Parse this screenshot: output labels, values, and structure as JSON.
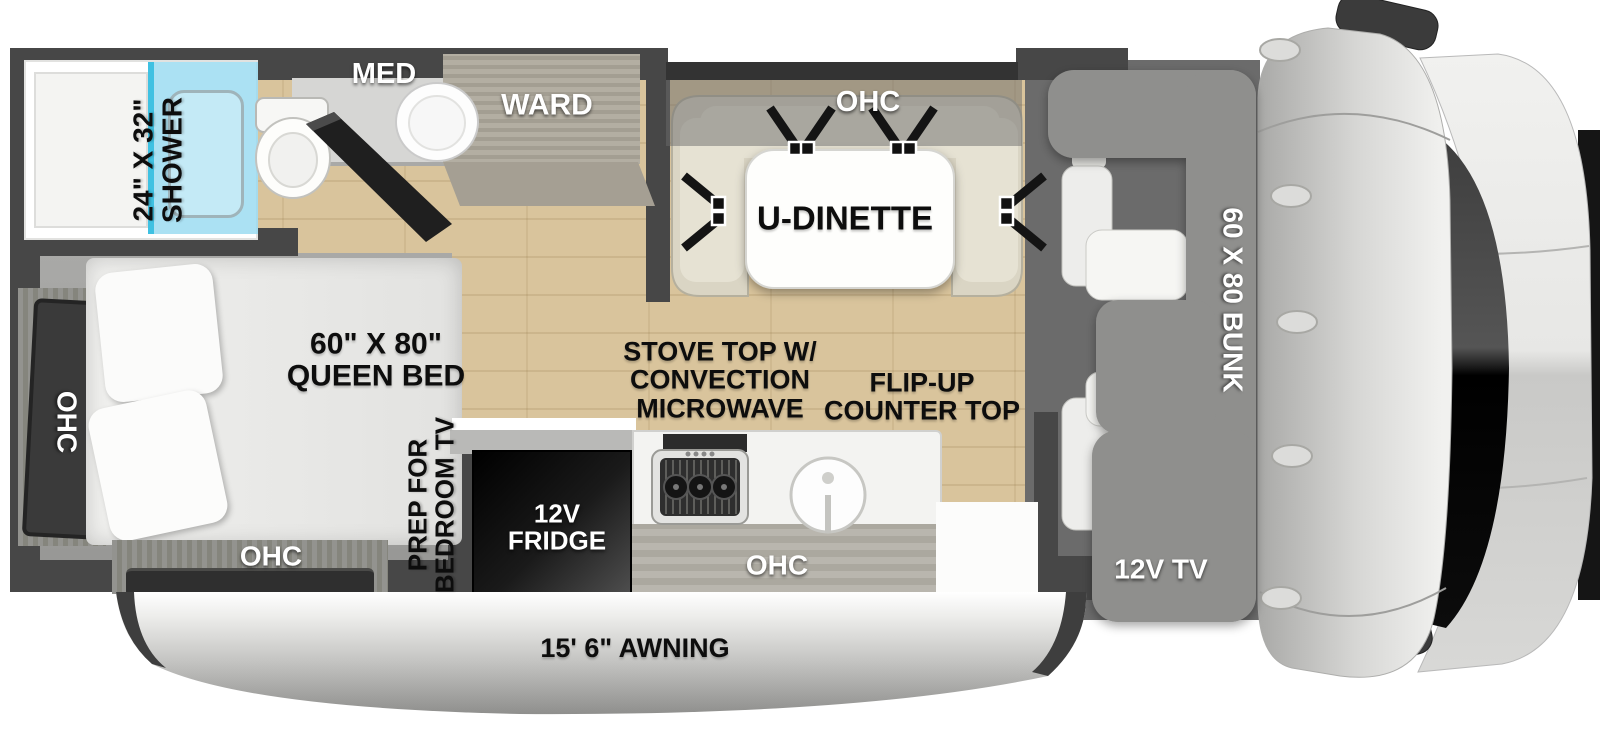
{
  "type": "rv-floorplan-diagram",
  "labels": {
    "shower": [
      "24\" X 32\"",
      "SHOWER"
    ],
    "med": "MED",
    "ward": "WARD",
    "dinette_ohc": "OHC",
    "dinette": "U-DINETTE",
    "bunk": "60 X 80 BUNK",
    "cab_tv": "12V TV",
    "queen_bed": [
      "60\" X 80\"",
      "QUEEN BED"
    ],
    "bed_ohc_side": "OHC",
    "bed_ohc_rear": "OHC",
    "bedroom_tv_prep": [
      "PREP FOR",
      "BEDROOM TV"
    ],
    "stove": [
      "STOVE TOP W/",
      "CONVECTION",
      "MICROWAVE"
    ],
    "counter": [
      "FLIP-UP",
      "COUNTER TOP"
    ],
    "fridge": [
      "12V",
      "FRIDGE"
    ],
    "kitchen_ohc": "OHC",
    "awning": "15' 6\" AWNING"
  },
  "colors": {
    "wall": "#474747",
    "wood_floor": "#d9c49c",
    "carpet": "#a2a2a0",
    "shower_glass": "#aee4f4",
    "shower_glass_edge": "#3fc1e2",
    "bunk": "#8f8f8d",
    "cab_floor": "#6b6b6b",
    "dinette_seat": "#dad5c4",
    "fridge_black": "#161616",
    "label_black": "#0d0d0d",
    "label_white": "#ffffff"
  }
}
